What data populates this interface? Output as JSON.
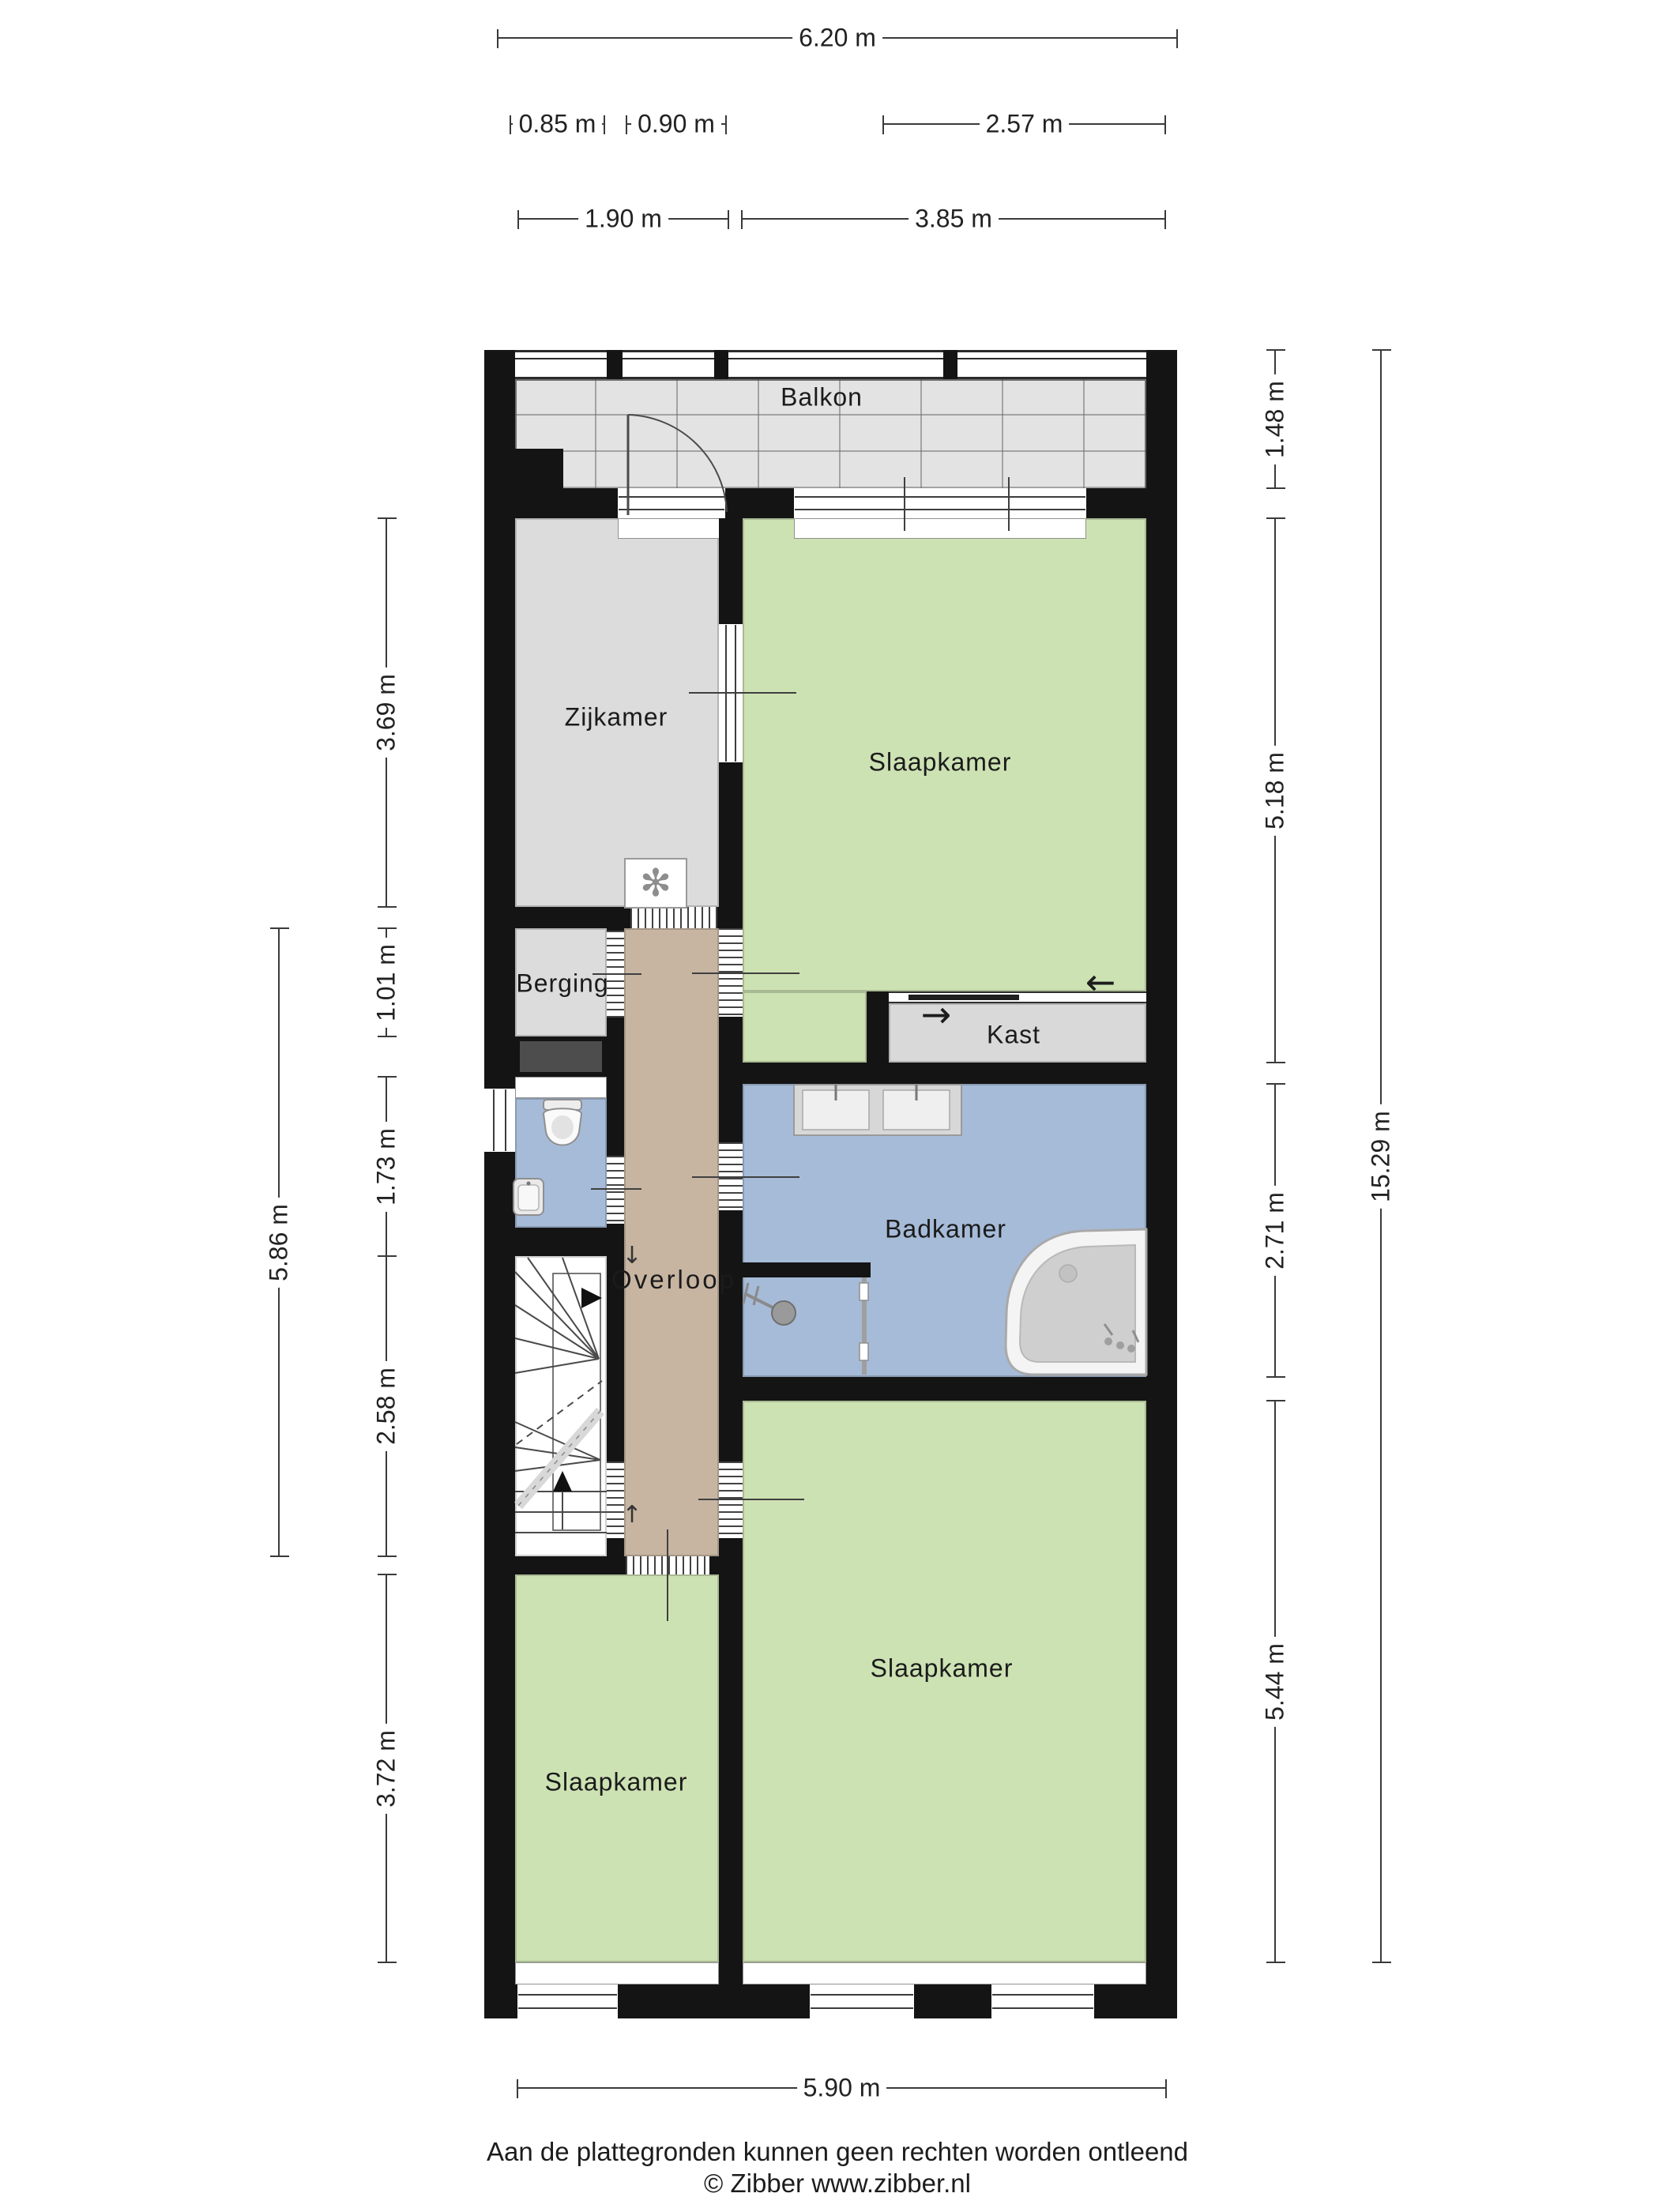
{
  "rooms": {
    "balkon": "Balkon",
    "zijkamer": "Zijkamer",
    "slaapkamer_top": "Slaapkamer",
    "berging": "Berging",
    "kast": "Kast",
    "overloop": "Overloop",
    "badkamer": "Badkamer",
    "slaapkamer_rechts": "Slaapkamer",
    "slaapkamer_links": "Slaapkamer"
  },
  "dimensions": {
    "top_total": "6.20 m",
    "top_row2": [
      "0.85 m",
      "0.90 m",
      "2.57 m"
    ],
    "top_row3": [
      "1.90 m",
      "3.85 m"
    ],
    "left": [
      "3.69 m",
      "1.01 m",
      "1.73 m",
      "2.58 m",
      "3.72 m"
    ],
    "left_outer": "5.86 m",
    "right": [
      "1.48 m",
      "5.18 m",
      "2.71 m",
      "5.44 m"
    ],
    "right_total": "15.29 m",
    "bottom": "5.90 m"
  },
  "footer": {
    "line1": "Aan de plattegronden kunnen geen rechten worden ontleend",
    "line2": "© Zibber www.zibber.nl"
  },
  "icons": {
    "fan": "✻",
    "arrow-left": "←",
    "arrow-right": "→",
    "arrow-up": "↑",
    "arrow-down": "↓"
  },
  "colors": {
    "wall": "#141414",
    "room-green": "#cde2b3",
    "room-blue": "#a6bbd8",
    "room-gray": "#dcdcdc",
    "balcony-gray": "#e3e3e3",
    "corridor-tan": "#c7b5a2",
    "duct-dark": "#4d4d4d",
    "dim-line": "#3a3a3a",
    "label-text": "#1b1b1b",
    "fixture-gray": "#9a9a9a"
  }
}
